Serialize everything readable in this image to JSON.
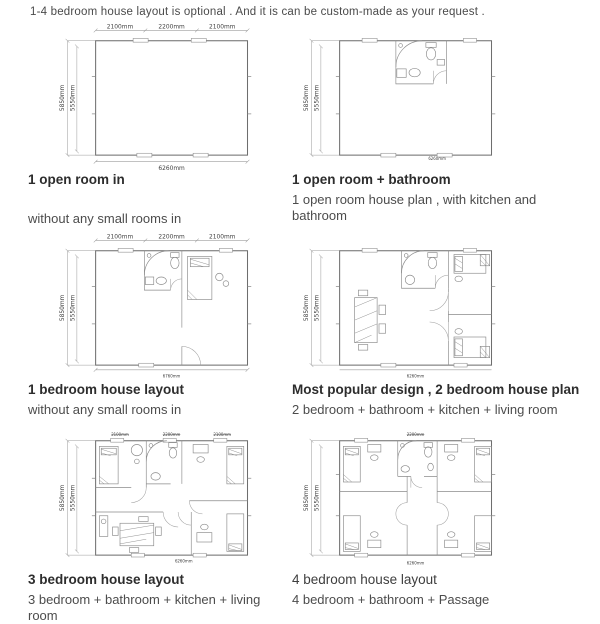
{
  "header": "1-4 bedroom house layout is optional . And it is can be custom-made as your request .",
  "dims": {
    "top": [
      "2100mm",
      "2200mm",
      "2100mm"
    ],
    "left_outer": "5850mm",
    "left_inner": "5550mm",
    "bottom": "6260mm",
    "bottom_alt": "6760mm"
  },
  "plans": [
    {
      "title": "1 open room in",
      "subtitle": "without any small rooms in"
    },
    {
      "title": "1 open room + bathroom",
      "subtitle": "1 open room  house plan , with kitchen and bathroom"
    },
    {
      "title": "1 bedroom  house layout",
      "subtitle": "without any small rooms in"
    },
    {
      "title": "Most popular design , 2 bedroom house plan",
      "subtitle": "2 bedroom + bathroom + kitchen + living room"
    },
    {
      "title": "3  bedroom house layout",
      "subtitle": "3 bedroom + bathroom + kitchen + living room"
    },
    {
      "title": "4  bedroom house layout",
      "subtitle": "4 bedroom + bathroom  + Passage"
    }
  ],
  "colors": {
    "title_text": "#2d2d2d",
    "body_text": "#4c4c4c",
    "plan_line": "#6e6e6e"
  }
}
